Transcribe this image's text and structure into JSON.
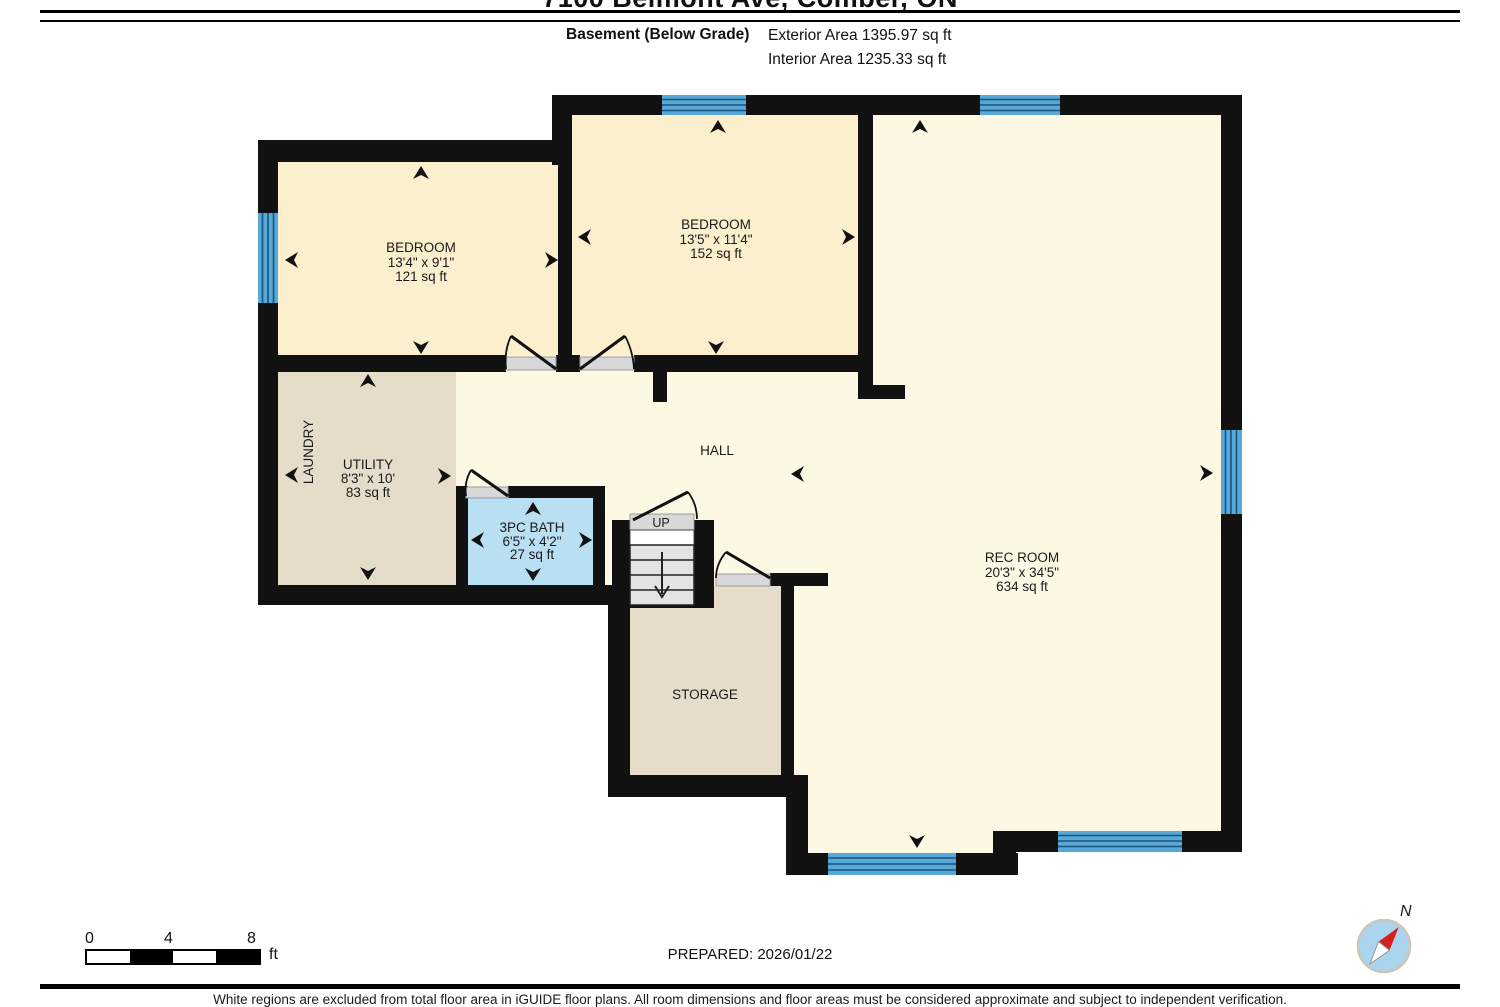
{
  "header": {
    "title": "7100 Belmont Ave, Comber, ON",
    "floor_label": "Basement (Below Grade)",
    "exterior_area": "Exterior Area 1395.97 sq ft",
    "interior_area": "Interior Area 1235.33 sq ft"
  },
  "rooms": {
    "bedroom1": {
      "name": "BEDROOM",
      "dims": "13'4\" x 9'1\"",
      "area": "121 sq ft"
    },
    "bedroom2": {
      "name": "BEDROOM",
      "dims": "13'5\" x 11'4\"",
      "area": "152 sq ft"
    },
    "utility": {
      "name": "UTILITY",
      "dims": "8'3\" x 10'",
      "area": "83 sq ft"
    },
    "laundry": {
      "name": "LAUNDRY"
    },
    "hall": {
      "name": "HALL"
    },
    "bath": {
      "name": "3PC BATH",
      "dims": "6'5\" x 4'2\"",
      "area": "27 sq ft"
    },
    "rec_room": {
      "name": "REC ROOM",
      "dims": "20'3\" x 34'5\"",
      "area": "634 sq ft"
    },
    "storage": {
      "name": "STORAGE"
    },
    "stairs": {
      "label": "UP"
    }
  },
  "footer": {
    "scale_ticks": [
      "0",
      "4",
      "8"
    ],
    "scale_unit": "ft",
    "prepared": "PREPARED: 2026/01/22",
    "compass_label": "N",
    "disclaimer": "White regions are excluded from total floor area in iGUIDE floor plans. All room dimensions and floor areas must be considered approximate and subject to independent verification."
  },
  "colors": {
    "wall": "#111111",
    "room_fill": "#FBEFCD",
    "open_fill": "#FDF8E4",
    "service_fill": "#E5DDC9",
    "bath_fill": "#B8DFF2",
    "window_fill": "#58A9D7",
    "window_line": "#17547C"
  }
}
